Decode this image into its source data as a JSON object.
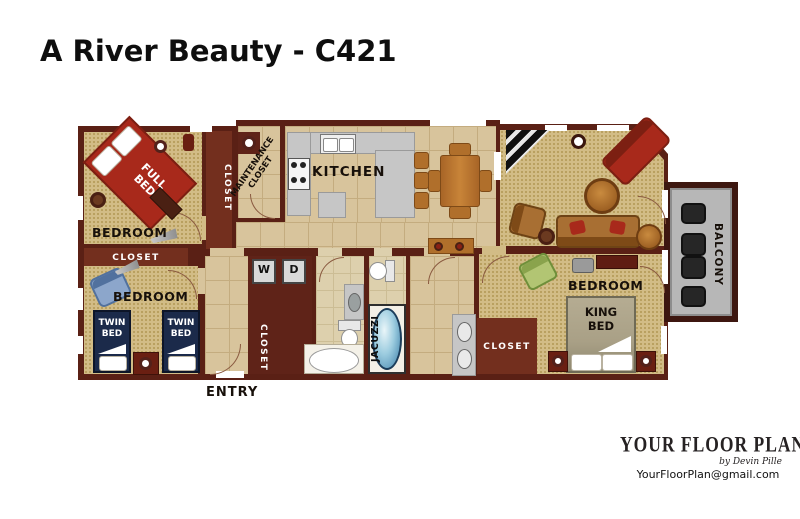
{
  "title": "A River Beauty - C421",
  "plan": {
    "rooms": {
      "bedroom_label": "BEDROOM",
      "kitchen": "KITCHEN",
      "entry": "ENTRY",
      "balcony": "BALCONY",
      "maintenance_closet": "MAINTENANCE CLOSET",
      "closet": "CLOSET",
      "jacuzzi": "JACUZZI"
    },
    "furniture": {
      "full_bed": "FULL BED",
      "twin_bed": "TWIN BED",
      "king_bed": "KING BED",
      "washer": "W",
      "dryer": "D"
    }
  },
  "logo": {
    "name": "YOUR FLOOR PLAN",
    "byline": "by Devin Pille",
    "email": "YourFloorPlan@gmail.com"
  },
  "colors": {
    "wall": "#5a2015",
    "floor_tile": "#d8c49c",
    "carpet": "#d2bc86",
    "closet": "#732f1e",
    "accent_red": "#a8291b",
    "navy_bed": "#1b2a4a",
    "jacuzzi_blue": "#5e9abc",
    "balcony_gray": "#b7b7b7",
    "counter_gray": "#c6c6c6",
    "wood": "#b06f2b",
    "king_bed_tan": "#a9a086",
    "green_chair": "#b2c573",
    "blue_chair": "#8ca6cb"
  }
}
